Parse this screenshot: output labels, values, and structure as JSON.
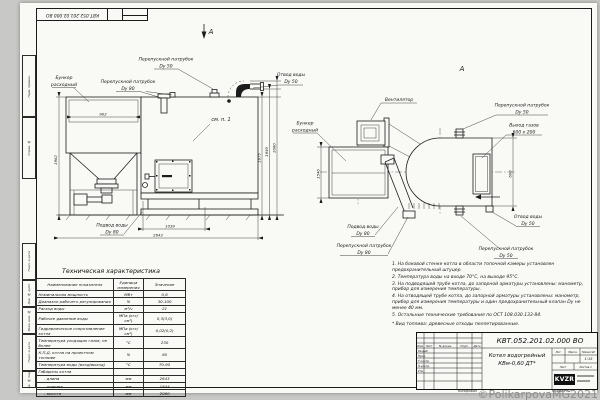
{
  "watermark": "©PolikarpovaMG2021",
  "frame": {
    "doc_number_rotated": "КВТ.052.201.02.000 ВО",
    "margin_labels": [
      "Перв. примен.",
      "Справ. №",
      "Подп. и дата",
      "Инв. № дубл.",
      "Взам. инв. №",
      "Подп. и дата",
      "Инв. № подл."
    ]
  },
  "front_view": {
    "view_arrow": "А",
    "see_ref": "см. п. 1",
    "labels": {
      "bunker_l1": "Бункер",
      "bunker_l2": "расходный",
      "bypass80_l1": "Перепускной патрубок",
      "bypass80_l2": "Dy 80",
      "bypass50_l1": "Перепускной патрубок",
      "bypass50_l2": "Dy 50",
      "water_out_l1": "Отвод воды",
      "water_out_l2": "Dy 50",
      "water_in_l1": "Подвод воды",
      "water_in_l2": "Dy 80"
    },
    "dims": {
      "hopper_width": "902",
      "hopper_height": "1962",
      "base_length": "1039",
      "total_length": "2643",
      "h_body": "1875",
      "h_nozzle": "1939",
      "h_total": "2080"
    }
  },
  "top_view": {
    "view_mark": "А",
    "labels": {
      "fan": "Вентилятор",
      "bunker_l1": "Бункер",
      "bunker_l2": "расходный",
      "bypass50_top_l1": "Перепускной патрубок",
      "bypass50_top_l2": "Dy 50",
      "gas_out_l1": "Выход газов",
      "gas_out_l2": "600 x 200",
      "water_out_l1": "Отвод воды",
      "water_out_l2": "Dy 50",
      "water_in_l1": "Подвод воды",
      "water_in_l2": "Dy 80",
      "bypass80_l1": "Перепускной патрубок",
      "bypass80_l2": "Dy 80",
      "bypass50_bot_l1": "Перепускной патрубок",
      "bypass50_bot_l2": "Dy 50"
    },
    "dims": {
      "depth": "1546",
      "gas_height": "600"
    }
  },
  "spec_table": {
    "title": "Техническая характеристика",
    "headers": [
      "Наименование показателя",
      "Единица измерения",
      "Значение"
    ],
    "rows": [
      [
        "Номинальная мощность",
        "МВт",
        "0,6"
      ],
      [
        "Диапазон рабочего регулирования",
        "%",
        "30-100"
      ],
      [
        "Расход воды",
        "м³/ч",
        "21"
      ],
      [
        "Рабочее давление воды",
        "МПа (кгс/см²)",
        "0,3(3,0)"
      ],
      [
        "Гидравлическое сопротивление котла",
        "МПа (кгс/см²)",
        "0,02(0,2)"
      ],
      [
        "Температура уходящих газов, не более",
        "°С",
        "230"
      ],
      [
        "К.П.Д. котла на проектном топливе",
        "%",
        "80"
      ],
      [
        "Температура воды (вход/выход)",
        "°С",
        "70-95"
      ],
      [
        "Габариты котла",
        "",
        ""
      ],
      [
        "- длина",
        "мм",
        "2643"
      ],
      [
        "- ширина",
        "мм",
        "1844"
      ],
      [
        "- высота",
        "мм",
        "2080"
      ]
    ]
  },
  "notes": {
    "items": [
      "1. На боковой стенке котла в области топочной камеры установлен предохранительный штуцер.",
      "2. Температура воды на входе 70°С, на выходе 95°С.",
      "3. На подводящей трубе котла, до запорной арматуры установлены: манометр, прибор для измерения температуры.",
      "4. На отводящей трубе котла, до запорной арматуры установлены: манометр, прибор для измерения температуры и один предохранительный клапан Dy не менее 40 мм.",
      "5. Остальные технические требования по ОСТ 108.030.133-84."
    ],
    "fuel": "* Вид топлива: древесные отходы пеллетированные."
  },
  "title_block": {
    "doc_number": "КВТ.052.201.02.000  ВО",
    "product_l1": "Котел водогрейный",
    "product_l2": "КВм-0,60   ДТ*",
    "col_headers": [
      "Изм.",
      "Лист",
      "№ докум.",
      "Подп.",
      "Дата"
    ],
    "roles": [
      "Разраб.",
      "Пров.",
      "Т.контр.",
      "Н.контр.",
      "Утв."
    ],
    "lit_h": "Лит.",
    "mass_h": "Масса",
    "scale_h": "Масштаб",
    "scale": "1:15",
    "sheet_h": "Лист",
    "sheets_h": "Листов 1",
    "logo": "KVZR",
    "copied": "Копировал",
    "format": "Формат A2"
  }
}
